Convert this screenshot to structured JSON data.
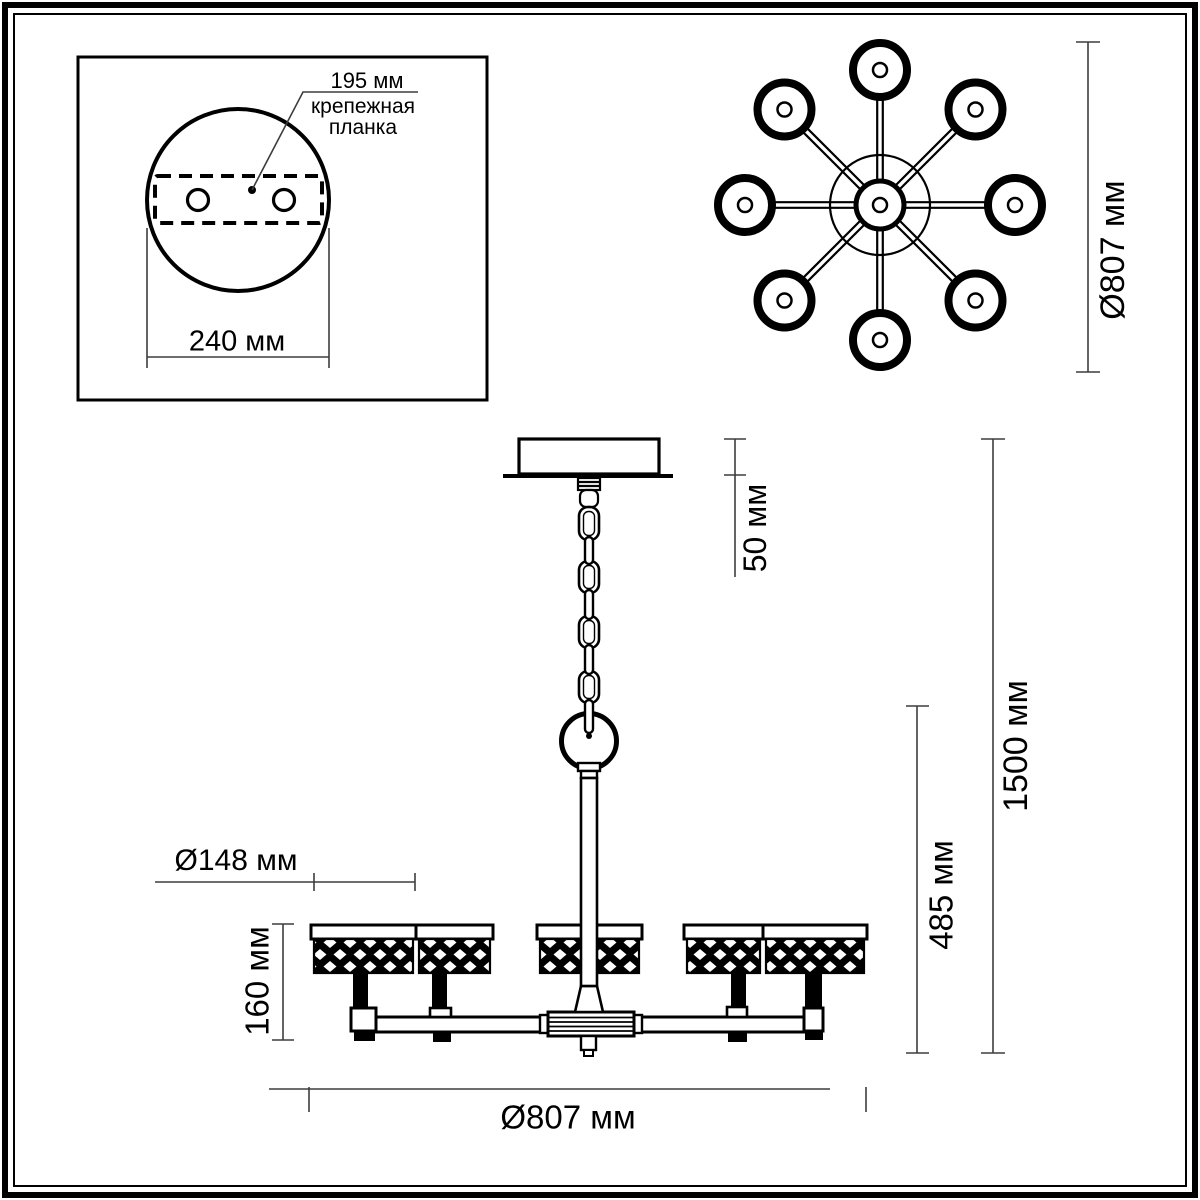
{
  "inset": {
    "hole_spacing_label": "195 мм",
    "bracket_label_line1": "крепежная",
    "bracket_label_line2": "планка",
    "plate_width_label": "240 мм"
  },
  "top_view": {
    "diameter_label": "Ø807 мм"
  },
  "side_view": {
    "canopy_height_label": "50 мм",
    "total_height_label": "1500 мм",
    "body_height_label": "485 мм",
    "shade_diameter_label": "Ø148 мм",
    "shade_height_label": "160 мм",
    "diameter_label": "Ø807 мм"
  },
  "colors": {
    "outline": "#000000",
    "dimension_line": "#3d3d3d",
    "background": "#ffffff"
  }
}
